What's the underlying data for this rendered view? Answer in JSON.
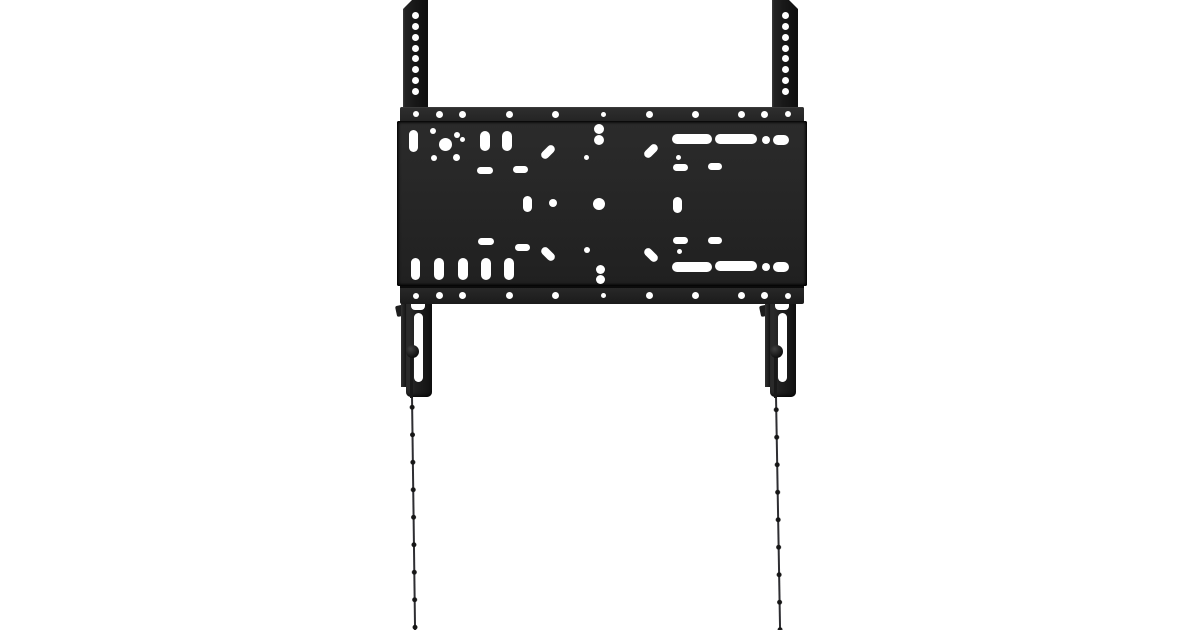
{
  "scene": {
    "type": "product-photo",
    "subject": "Fixed TV wall-mount bracket: black perforated wall plate, two vertical mounting rails with hole columns, two locking brackets with slots and knobs, and two beaded pull cords hanging down",
    "colors": {
      "background": "#ffffff",
      "cutout_white": "#ffffff",
      "metal_face": "#272727",
      "metal_dark": "#1b1b1b",
      "metal_edge": "#0e0e0e",
      "metal_highlight": "#3c3c3c",
      "cord": "#2e2e32",
      "bead": "#161616"
    }
  },
  "rails": {
    "top": 0,
    "height": 125,
    "hole_d": 7,
    "hole_ys": [
      15,
      26,
      37,
      48,
      58,
      69,
      80,
      91
    ],
    "left": {
      "x": 403,
      "w": 25
    },
    "right": {
      "x": 772,
      "w": 26
    }
  },
  "plate": {
    "x": 397,
    "y": 107,
    "w": 410,
    "h": 195,
    "top_strip_h": 13.5,
    "bottom_strip_h": 16,
    "top_row_y": 114,
    "bottom_row_y": 295.5,
    "flange_holes": [
      [
        416,
        6
      ],
      [
        439,
        7
      ],
      [
        462,
        7
      ],
      [
        509,
        7
      ],
      [
        555,
        7
      ],
      [
        603,
        5
      ],
      [
        649,
        7
      ],
      [
        695,
        7
      ],
      [
        741,
        7
      ],
      [
        764,
        7
      ],
      [
        788,
        6
      ]
    ],
    "face_holes": [
      [
        413,
        141,
        9,
        22,
        0
      ],
      [
        433,
        131,
        6,
        6,
        0
      ],
      [
        457,
        135,
        6,
        6,
        0
      ],
      [
        445,
        144,
        13,
        13,
        0
      ],
      [
        434,
        158,
        6,
        6,
        0
      ],
      [
        456,
        157,
        7,
        7,
        0
      ],
      [
        462,
        139,
        5,
        5,
        0
      ],
      [
        485,
        141,
        10,
        20,
        0
      ],
      [
        507,
        141,
        10,
        20,
        0
      ],
      [
        599,
        129,
        10,
        10,
        0
      ],
      [
        599,
        140,
        10,
        10,
        0
      ],
      [
        548,
        152,
        16,
        8,
        -45
      ],
      [
        651,
        151,
        16,
        8,
        -45
      ],
      [
        586,
        157,
        5,
        5,
        0
      ],
      [
        678,
        157,
        5,
        5,
        0
      ],
      [
        485,
        170,
        16,
        7,
        0
      ],
      [
        520,
        169,
        15,
        7,
        0
      ],
      [
        680,
        167,
        15,
        7,
        0
      ],
      [
        715,
        166,
        14,
        7,
        0
      ],
      [
        692,
        139,
        40,
        10,
        0
      ],
      [
        736,
        139,
        42,
        10,
        0
      ],
      [
        766,
        140,
        8,
        8,
        0
      ],
      [
        781,
        140,
        16,
        10,
        0
      ],
      [
        527,
        204,
        9,
        16,
        0
      ],
      [
        553,
        203,
        8,
        8,
        0
      ],
      [
        599,
        204,
        12,
        12,
        0
      ],
      [
        677,
        205,
        9,
        16,
        0
      ],
      [
        486,
        241,
        16,
        7,
        0
      ],
      [
        522,
        247,
        15,
        7,
        0
      ],
      [
        680,
        240,
        15,
        7,
        0
      ],
      [
        715,
        240,
        14,
        7,
        0
      ],
      [
        587,
        250,
        6,
        6,
        0
      ],
      [
        679,
        251,
        5,
        5,
        0
      ],
      [
        548,
        254,
        16,
        8,
        45
      ],
      [
        651,
        255,
        16,
        8,
        45
      ],
      [
        600,
        269,
        9,
        9,
        0
      ],
      [
        600,
        279,
        9,
        9,
        0
      ],
      [
        415,
        269,
        9,
        22,
        0
      ],
      [
        439,
        269,
        10,
        22,
        0
      ],
      [
        463,
        269,
        10,
        22,
        0
      ],
      [
        486,
        269,
        10,
        22,
        0
      ],
      [
        509,
        269,
        10,
        22,
        0
      ],
      [
        692,
        267,
        40,
        10,
        0
      ],
      [
        736,
        266,
        42,
        10,
        0
      ],
      [
        766,
        267,
        8,
        8,
        0
      ],
      [
        781,
        267,
        16,
        10,
        0
      ]
    ]
  },
  "brackets": {
    "y": 301,
    "left": {
      "x": 396
    },
    "right": {
      "x": 760
    }
  },
  "cords": {
    "bead_spacing": 27.5,
    "line_w": 2,
    "left": {
      "x": 408.5,
      "top": 396,
      "height": 234,
      "tilt_deg": -0.75,
      "first_bead_offset": 25
    },
    "right": {
      "x": 773,
      "top": 396,
      "height": 234,
      "tilt_deg": -1.0,
      "first_bead_offset": 0
    }
  }
}
